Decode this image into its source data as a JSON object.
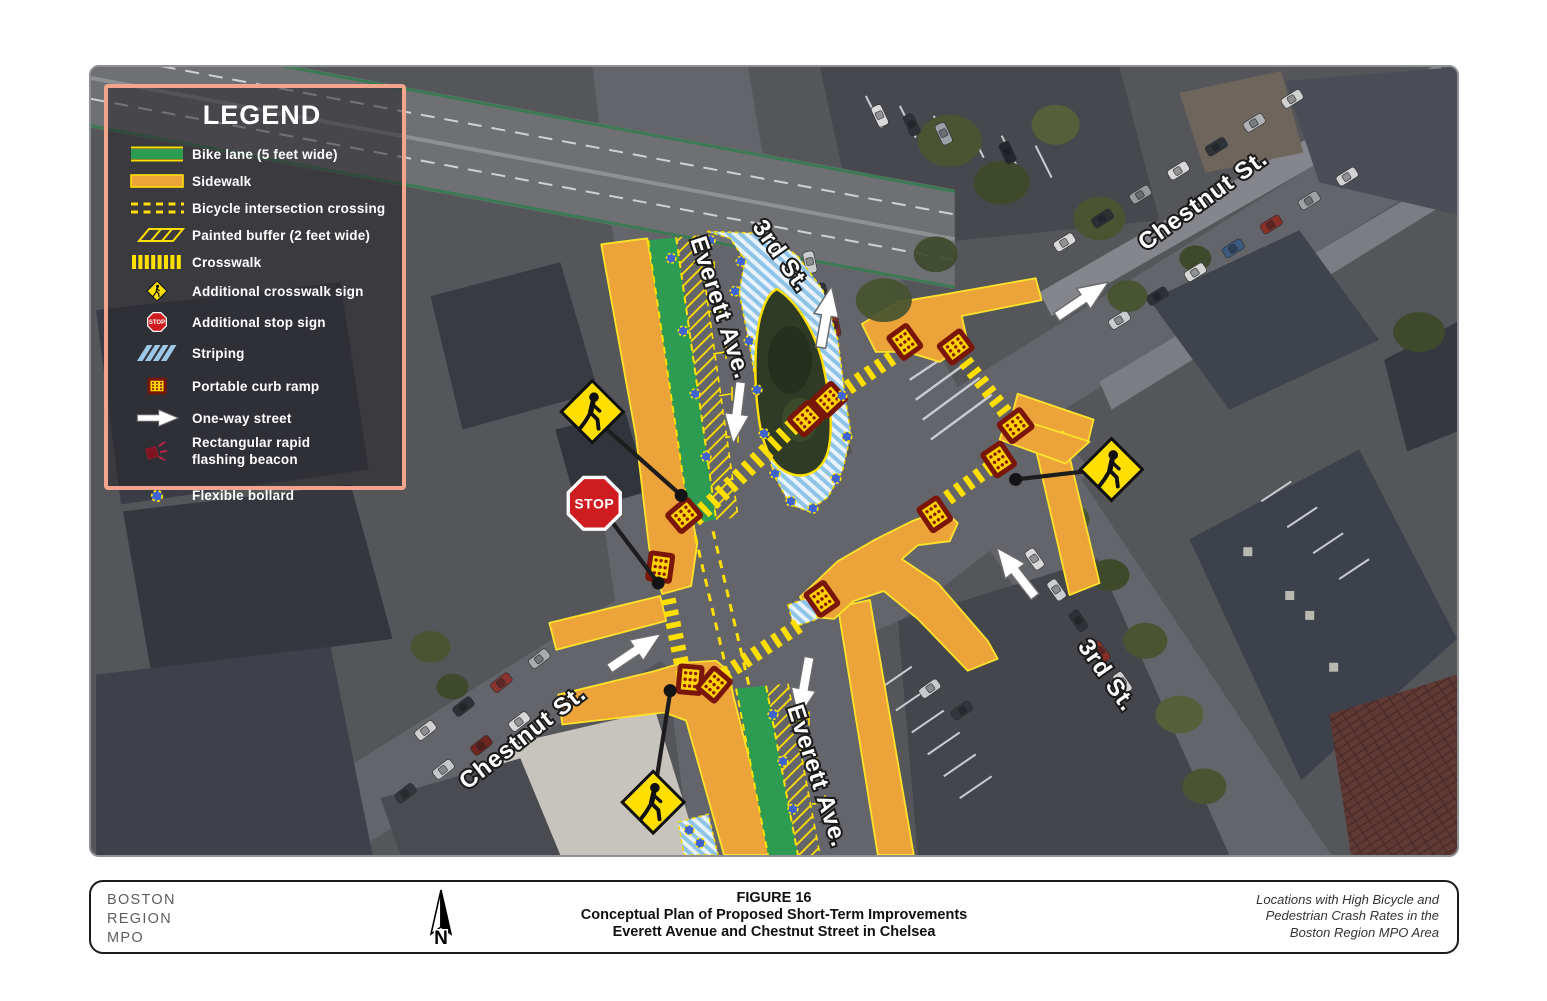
{
  "legend": {
    "title": "LEGEND",
    "items": [
      {
        "id": "bike-lane",
        "label": "Bike lane (5 feet wide)"
      },
      {
        "id": "sidewalk",
        "label": "Sidewalk"
      },
      {
        "id": "bicycle-intersection-crossing",
        "label": "Bicycle intersection crossing"
      },
      {
        "id": "painted-buffer",
        "label": "Painted buffer (2 feet wide)"
      },
      {
        "id": "crosswalk",
        "label": "Crosswalk"
      },
      {
        "id": "additional-crosswalk-sign",
        "label": "Additional crosswalk sign"
      },
      {
        "id": "additional-stop-sign",
        "label": "Additional stop sign"
      },
      {
        "id": "striping",
        "label": "Striping"
      },
      {
        "id": "portable-curb-ramp",
        "label": "Portable curb ramp"
      },
      {
        "id": "one-way-street",
        "label": "One-way street"
      },
      {
        "id": "rectangular-rapid-flashing-beacon",
        "label": "Rectangular rapid flashing beacon"
      },
      {
        "id": "flexible-bollard",
        "label": "Flexible bollard"
      }
    ]
  },
  "map": {
    "stop_sign_text": "STOP",
    "street_labels": [
      {
        "id": "everett-ave-north",
        "text": "Everett Ave."
      },
      {
        "id": "third-st-north",
        "text": "3rd St."
      },
      {
        "id": "chestnut-st-northeast",
        "text": "Chestnut St."
      },
      {
        "id": "chestnut-st-southwest",
        "text": "Chestnut St."
      },
      {
        "id": "everett-ave-south",
        "text": "Everett Ave."
      },
      {
        "id": "third-st-southeast",
        "text": "3rd St."
      }
    ]
  },
  "footer": {
    "agency_lines": [
      "BOSTON",
      "REGION",
      "MPO"
    ],
    "north_arrow_label": "N",
    "figure_number": "FIGURE 16",
    "figure_title_line1": "Conceptual Plan of Proposed Short-Term Improvements",
    "figure_title_line2": "Everett Avenue and Chestnut Street in Chelsea",
    "source_note_lines": [
      "Locations with High Bicycle and",
      "Pedestrian Crash Rates in the",
      "Boston Region MPO Area"
    ]
  },
  "colors": {
    "legend_border": "#f2a48c",
    "bike_lane_green": "#2d9c52",
    "sidewalk_orange": "#eca43a",
    "marking_yellow": "#ffe000",
    "striping_blue": "#9cc9ea",
    "curb_ramp_fill": "#ffd400",
    "curb_ramp_border": "#7a1608",
    "bollard_blue": "#3f63cf",
    "stop_sign_red": "#ce1c20",
    "sign_yellow": "#ffdf00"
  }
}
